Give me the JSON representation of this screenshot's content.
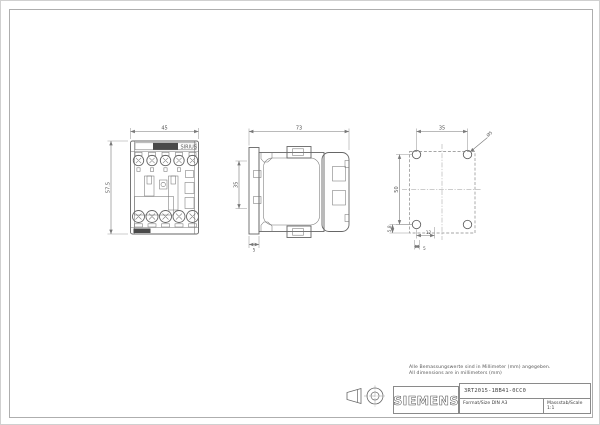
{
  "sheet": {
    "notes": {
      "line1": "Alle Bemassungswerte sind in Millimeter (mm) angegeben.",
      "line2": "All dimensions are in millimeters (mm)"
    },
    "colors": {
      "line": "#666666",
      "text": "#555555"
    }
  },
  "front_view": {
    "width_dim": "45",
    "height_dim": "57.5",
    "brand": "SIRIUS"
  },
  "side_view": {
    "depth_dim": "73",
    "rail_dim": "35",
    "plate_dim": "5"
  },
  "hole_pattern": {
    "h_spacing_dim": "35",
    "v_spacing_dim": "50",
    "hole_diameter": "Ø5",
    "edge_offset_dim": "5.8",
    "foot_offset_dim": "12",
    "foot_width_dim": "5"
  },
  "title_block": {
    "logo": "SIEMENS",
    "part_number": "3RT2015-1BB41-0CC0",
    "format": "Format/Size DIN A3",
    "scale": "Massstab/Scale 1:1"
  }
}
